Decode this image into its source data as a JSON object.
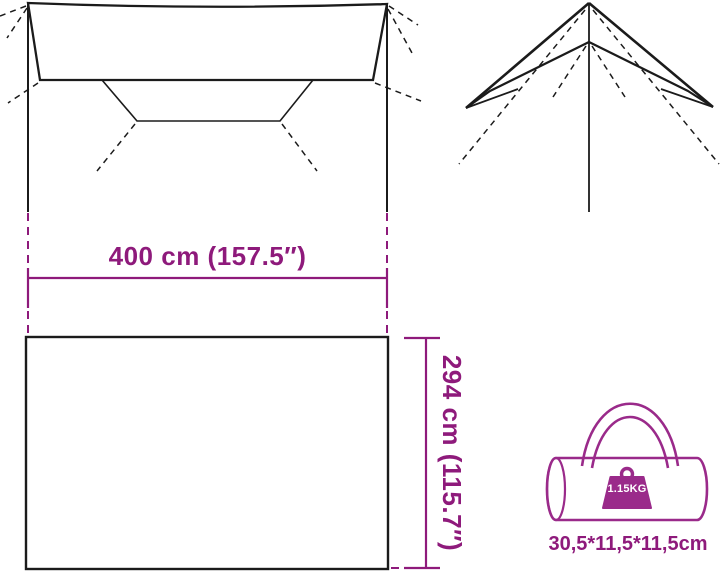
{
  "product_diagram": {
    "dimensions": {
      "width_label": "400 cm (157.5″)",
      "depth_label": "294 cm (115.7″)"
    },
    "package": {
      "weight_label": "1.15KG",
      "size_label": "30,5*11,5*11,5cm"
    }
  },
  "colors": {
    "accent": "#8E1A7B",
    "bag": "#9A2A8A",
    "line": "#1b1b1b",
    "background": "#ffffff",
    "weight_text": "#ffffff"
  }
}
